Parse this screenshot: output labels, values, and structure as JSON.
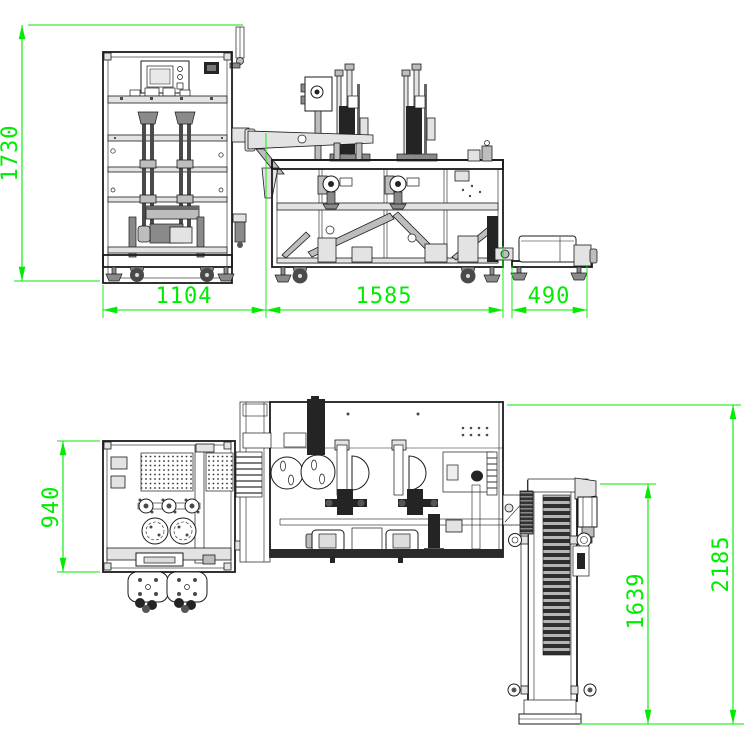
{
  "drawing": {
    "background": "#ffffff",
    "line_color": "#1b1b1b",
    "dimension_color": "#00ec00",
    "front_view": {
      "dims": [
        {
          "id": "overall-height",
          "label": "1730",
          "orientation": "vertical"
        },
        {
          "id": "feeder-machine-width",
          "label": "1104",
          "orientation": "horizontal"
        },
        {
          "id": "main-machine-width",
          "label": "1585",
          "orientation": "horizontal"
        },
        {
          "id": "outfeed-unit-width",
          "label": "490",
          "orientation": "horizontal"
        }
      ]
    },
    "plan_view": {
      "dims": [
        {
          "id": "feeder-machine-depth",
          "label": "940",
          "orientation": "vertical"
        },
        {
          "id": "conveyor-length",
          "label": "1639",
          "orientation": "vertical"
        },
        {
          "id": "overall-depth",
          "label": "2185",
          "orientation": "vertical"
        }
      ]
    }
  }
}
